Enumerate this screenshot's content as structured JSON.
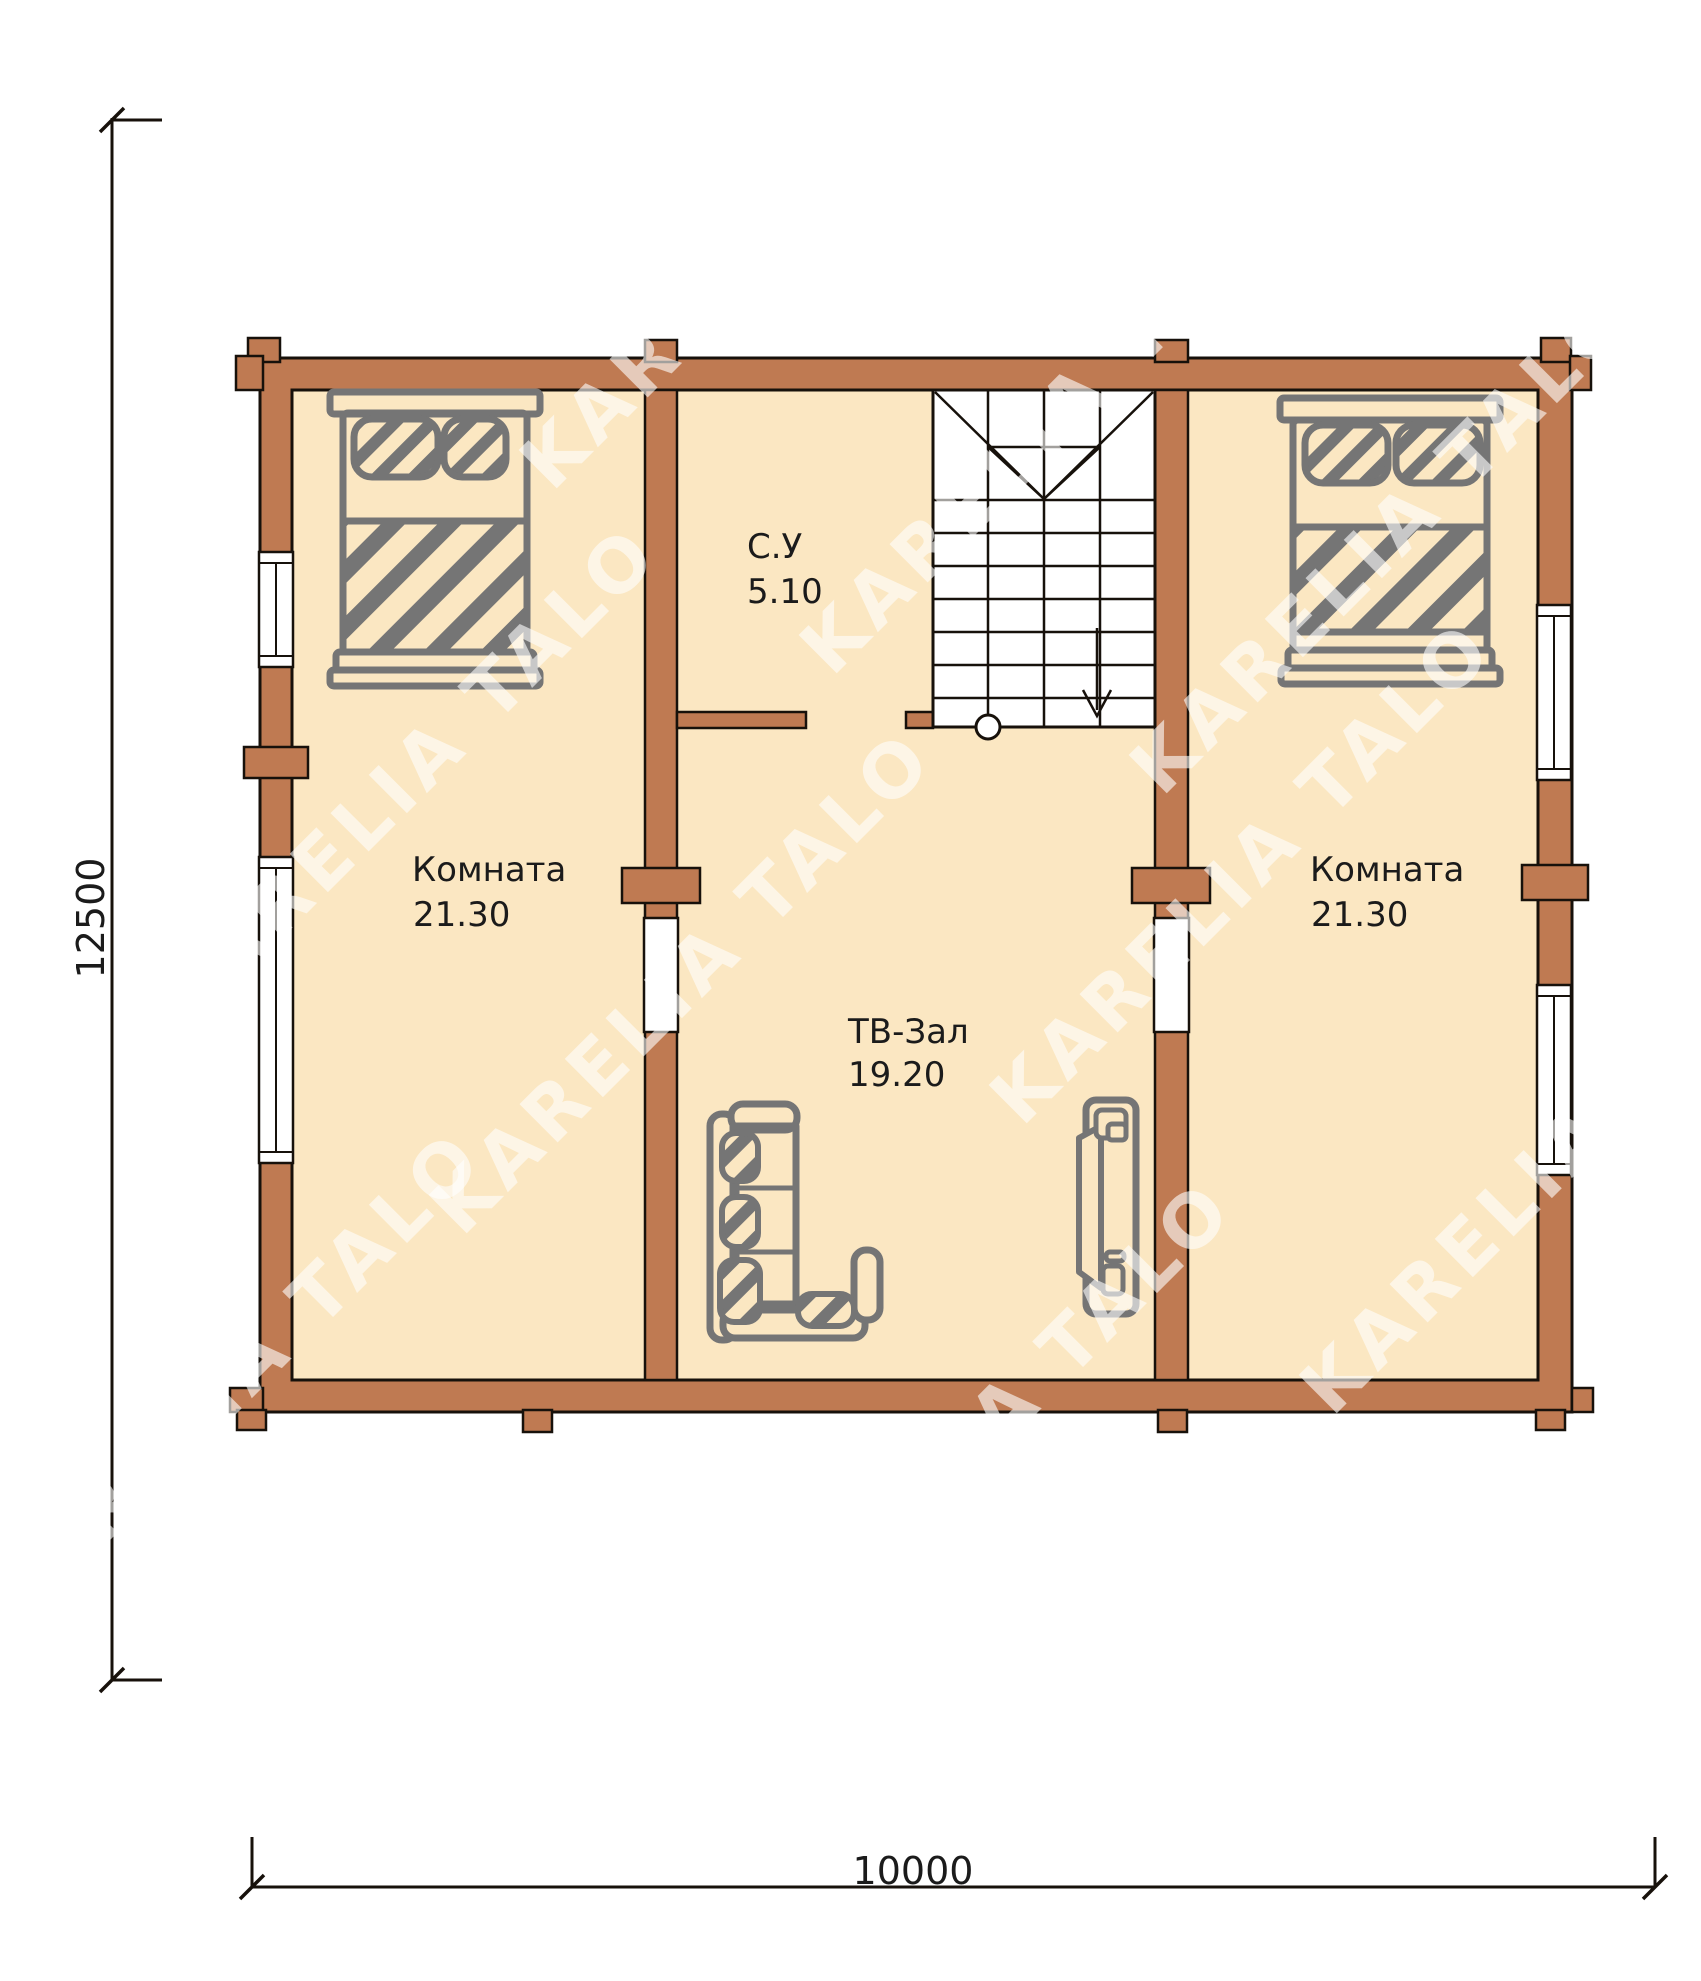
{
  "watermark": {
    "text": "KARELIA TALO"
  },
  "palette": {
    "wall": "#bf7a52",
    "floor": "#fbe7c2",
    "outline": "#17110b",
    "furniture": "#757575",
    "label": "#1b1b1b",
    "window": "#ffffff",
    "watermark": "#ffffff"
  },
  "rooms": {
    "left_bedroom": {
      "name": "Комната",
      "area": "21.30"
    },
    "right_bedroom": {
      "name": "Комната",
      "area": "21.30"
    },
    "bathroom": {
      "name": "С.У",
      "area": "5.10"
    },
    "tv_hall": {
      "name": "ТВ-Зал",
      "area": "19.20"
    }
  },
  "dimensions": {
    "height_mm": "12500",
    "width_mm": "10000"
  }
}
